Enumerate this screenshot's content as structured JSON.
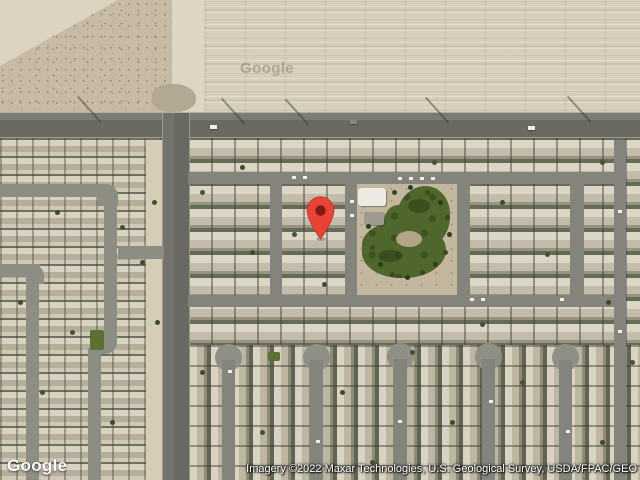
{
  "map": {
    "marker_color": "#EA4335",
    "marker_inner_color": "#7E1B12",
    "park_color": "#4f662c",
    "road_color": "#6a6a63"
  },
  "branding": {
    "logo": "Google",
    "ghost_watermark": "Google"
  },
  "attribution": {
    "text": "Imagery ©2022 Maxar Technologies, U.S. Geological Survey, USDA/FPAC/GEO"
  }
}
